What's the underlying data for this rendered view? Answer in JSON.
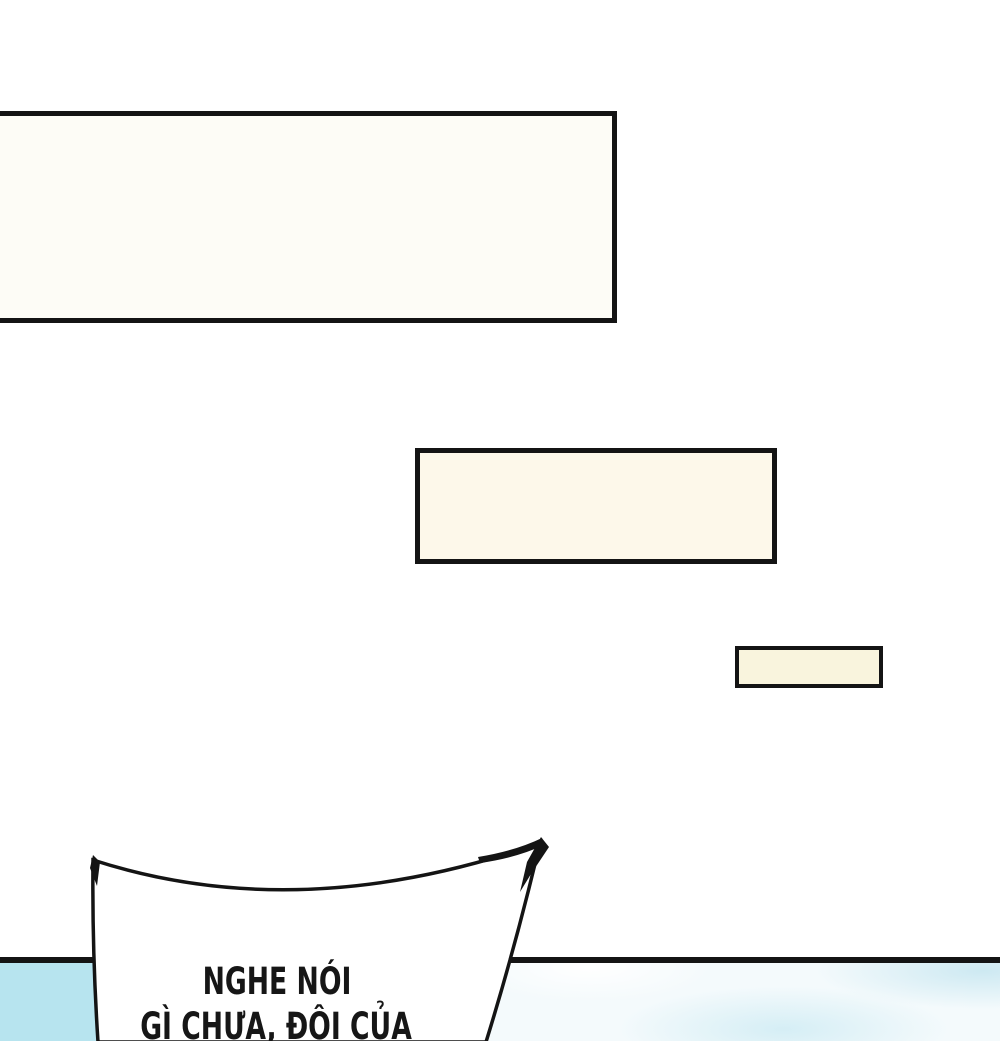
{
  "page": {
    "kind": "comic-page-fragment",
    "background": "#ffffff"
  },
  "colors": {
    "page-bg": "#ffffff",
    "ink": "#141414",
    "text-ink": "#161616",
    "box1-fill": "#fdfcf6",
    "box2-fill": "#fdf8ea",
    "box3-fill": "#f9f4dd",
    "sky-left": "#b7e4ef",
    "sky-cloud": "#d5eef5",
    "sky-cloud2": "#cde9f2",
    "bubble-fill": "#ffffff"
  },
  "speech_bubble": {
    "lines": [
      "NGHE NÓI",
      "GÌ CHƯA, ĐỘI CỦA"
    ]
  }
}
